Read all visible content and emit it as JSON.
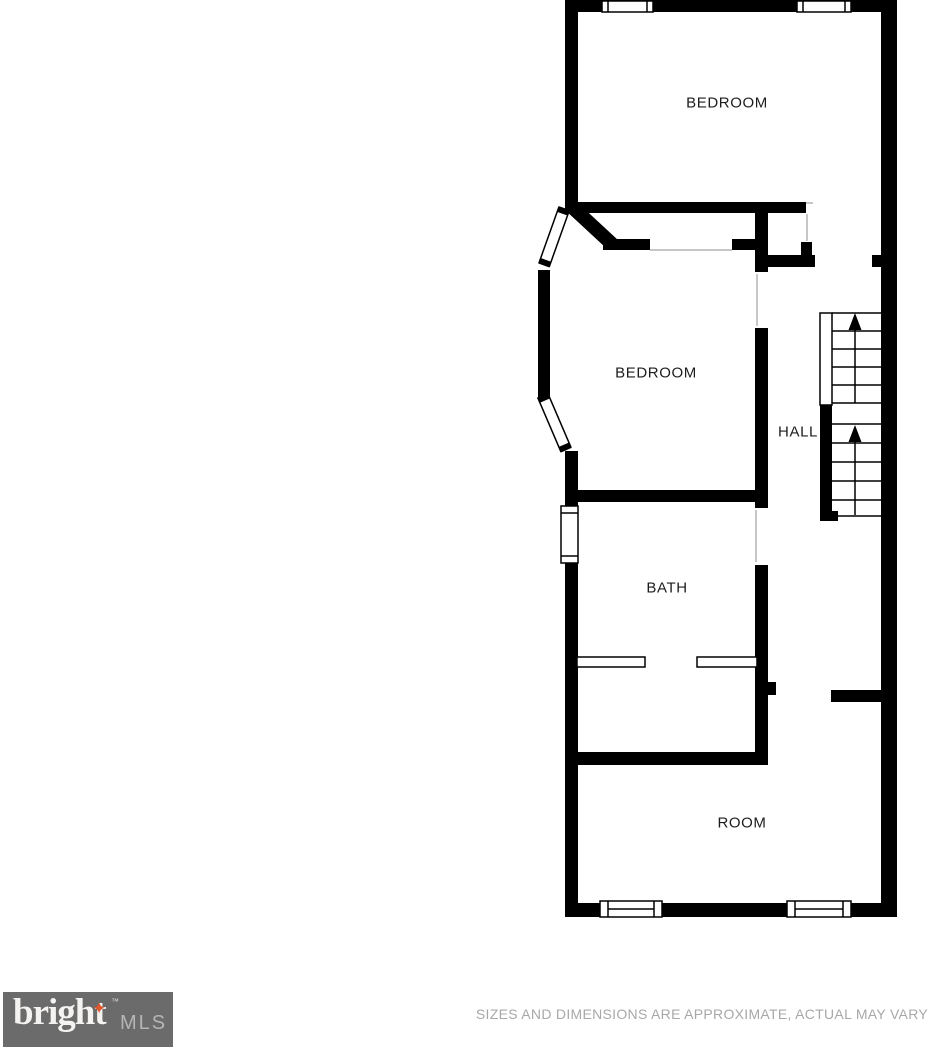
{
  "plan": {
    "rooms": [
      {
        "id": "bedroom-1",
        "label": "BEDROOM"
      },
      {
        "id": "bedroom-2",
        "label": "BEDROOM"
      },
      {
        "id": "hall",
        "label": "HALL"
      },
      {
        "id": "bath",
        "label": "BATH"
      },
      {
        "id": "room",
        "label": "ROOM"
      }
    ],
    "features": [
      "stairs-up-top-flight",
      "stairs-up-bottom-flight",
      "bay-window",
      "bath-window",
      "top-wall-windows",
      "bottom-wall-windows"
    ]
  },
  "footer": {
    "logo": {
      "brand": "bright",
      "suffix": "MLS",
      "trademark": "™",
      "star_icon": "✦",
      "bg_color": "#6b6b6b",
      "star_color": "#e0562c"
    },
    "disclaimer": "SIZES AND DIMENSIONS ARE APPROXIMATE, ACTUAL MAY VARY"
  },
  "colors": {
    "wall": "#000000",
    "label_text": "#1d1d1d",
    "disclaimer_text": "#a8a8a8"
  }
}
